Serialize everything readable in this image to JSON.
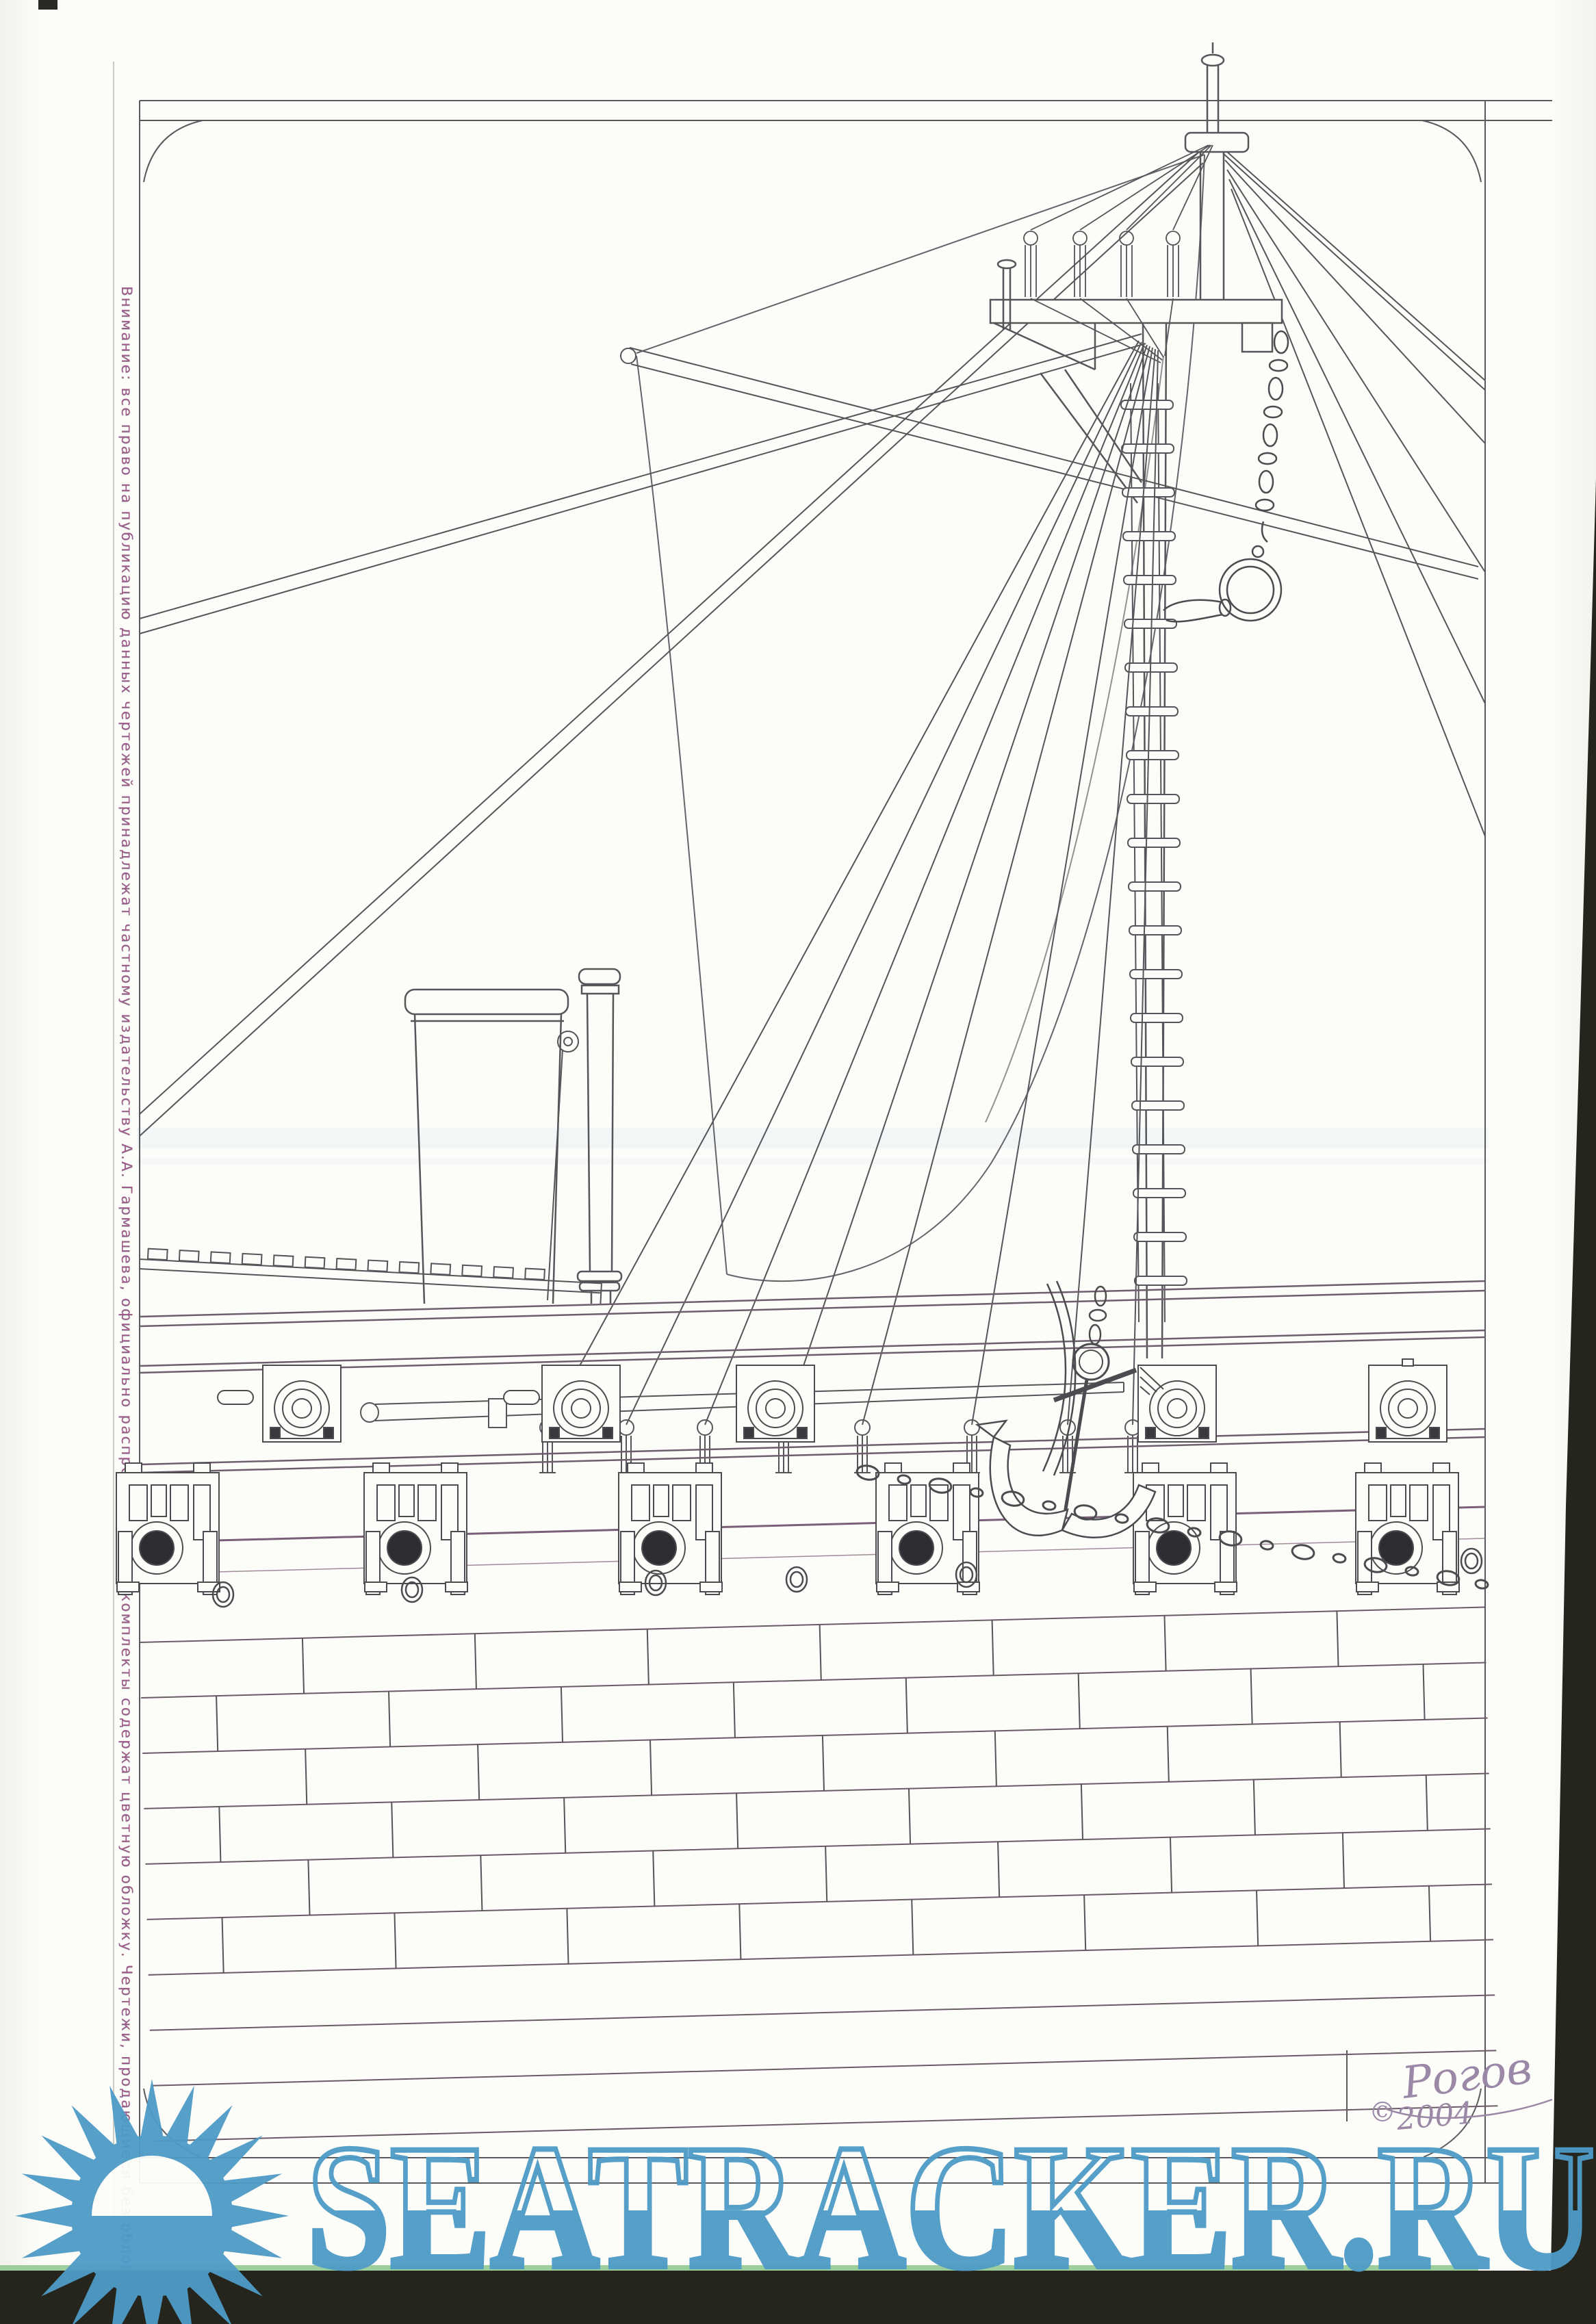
{
  "document": {
    "margin_note": "Внимание:  все  право  на  публикацию  данных  чертежей  принадлежат  частному  издательству  А.А. Гармашева,  официально  распространяемые  комплекты  содержат  цветную  обложку.  Чертежи,  продающиеся  без  обложки  -  это  пиратские  ксерокопии!",
    "signature": {
      "symbol": "©",
      "year": "2004",
      "name": "Рогов"
    },
    "watermark": {
      "text": "SEATRACKER.RU"
    },
    "colors": {
      "watermark_blue": "#4d9bc7",
      "ink": "#55555a",
      "band_line": "#6e5f6e",
      "margin_text": "#a05a8a",
      "paper": "#fcfcf8",
      "scan_edge": "#26251d"
    }
  }
}
